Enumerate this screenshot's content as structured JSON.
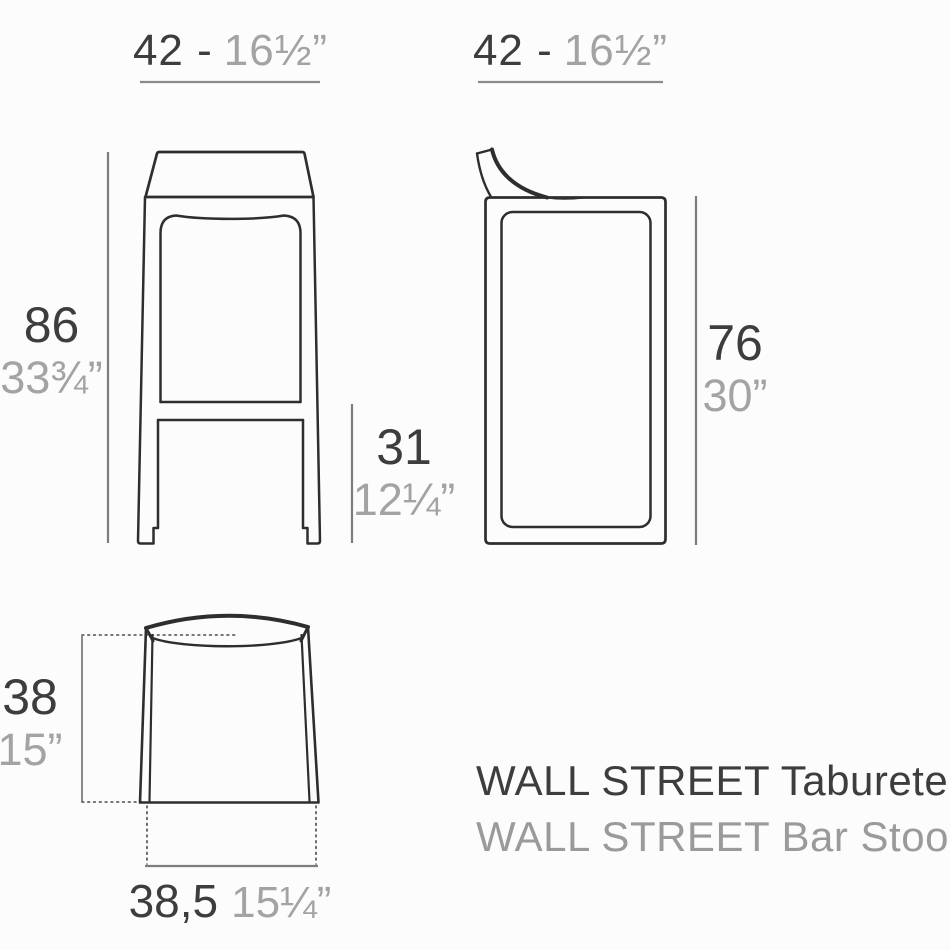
{
  "product": {
    "title_primary": "WALL STREET Taburete",
    "title_secondary": "WALL STREET Bar Stool"
  },
  "dimensions": {
    "front_width": {
      "cm": "42 -",
      "inches": "16½”"
    },
    "side_depth": {
      "cm": "42 -",
      "inches": "16½”"
    },
    "total_height": {
      "cm": "86",
      "inches": "33¾”"
    },
    "footrest_height": {
      "cm": "31",
      "inches": "12¼”"
    },
    "seat_height": {
      "cm": "76",
      "inches": "30”"
    },
    "top_depth": {
      "cm": "38",
      "inches": "15”"
    },
    "base_width": {
      "cm": "38,5",
      "inches": "15¼”"
    }
  },
  "colors": {
    "background": "#fcfcfc",
    "line_dark": "#2e2e2e",
    "dim_line": "#7d7d7d",
    "dotted_line": "#4a4a4a",
    "text_dark": "#3d3d3d",
    "text_gray": "#a3a3a3"
  }
}
